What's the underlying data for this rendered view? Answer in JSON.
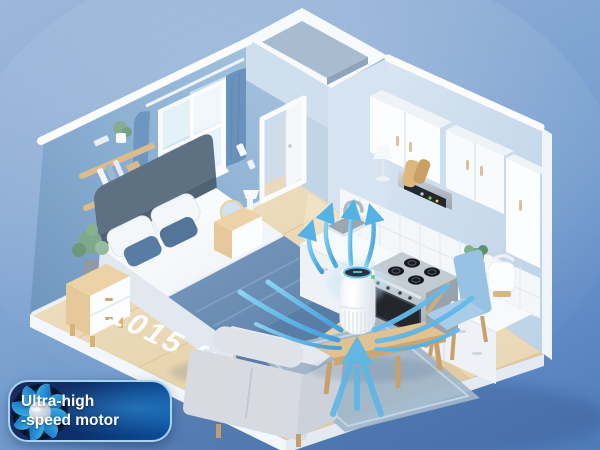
{
  "scene": {
    "floor_area_label": "1015 ft²"
  },
  "badge": {
    "line1": "Ultra-high",
    "line2": "-speed motor"
  },
  "colors": {
    "background_top": "#9cb7da",
    "background_bottom": "#4f7bb9",
    "airflow_accent": "#55b2e6",
    "badge_background_dark": "#112a5f",
    "badge_background_light": "#0a4e9b",
    "badge_border": "#a6d3f2",
    "badge_text": "#ffffff",
    "floor_label": "#ffffff",
    "bedroom_wall": "#84a9ce",
    "floor_wood": "#e7d3ae"
  }
}
